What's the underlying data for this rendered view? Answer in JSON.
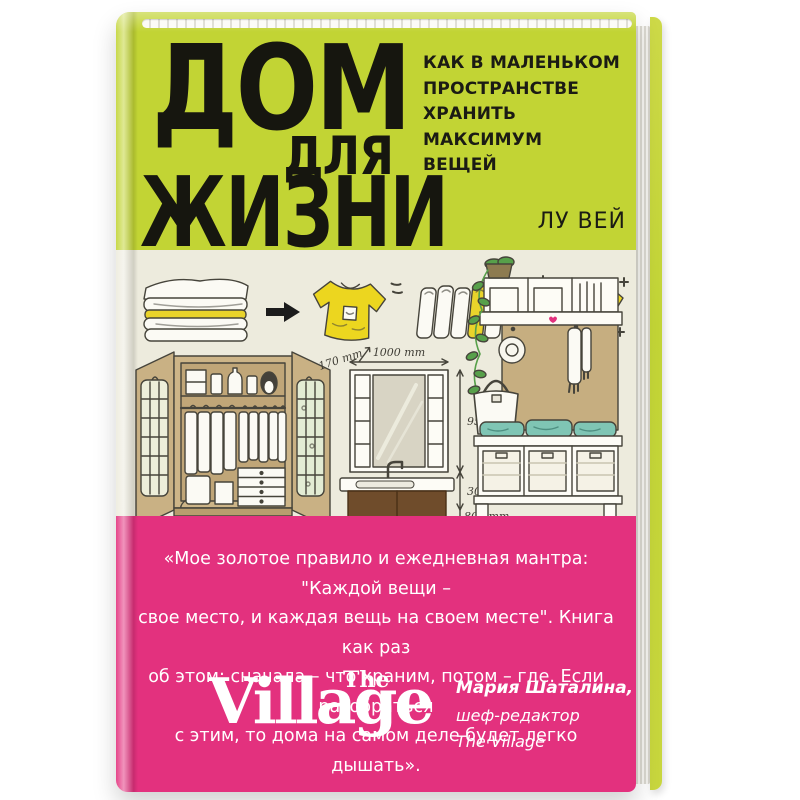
{
  "cover": {
    "title_lines": [
      "ДОМ",
      "ДЛЯ",
      "ЖИЗНИ"
    ],
    "subtitle_lines": [
      "КАК В МАЛЕНЬКОМ",
      "ПРОСТРАНСТВЕ",
      "ХРАНИТЬ",
      "МАКСИМУМ",
      "ВЕЩЕЙ"
    ],
    "author": "ЛУ ВЕЙ"
  },
  "illustration": {
    "measurements": {
      "cabinet_width": "1000 mm",
      "cabinet_depth": "170 mm",
      "cabinet_height": "950 mm",
      "gap_height": "300 mm",
      "sink_height": "800 mm"
    }
  },
  "quote": {
    "lines": [
      "«Мое золотое правило и ежедневная мантра: \"Каждой вещи –",
      "свое место, и каждая вещь на своем месте\". Книга как раз",
      "об этом: сначала – что храним, потом – где. Если разобраться",
      "с этим, то дома на самом деле будет легко дышать»."
    ]
  },
  "endorsement": {
    "logo_the": "The",
    "logo_village": "Village",
    "reviewer_name": "Мария Шаталина,",
    "reviewer_role": "шеф-редактор",
    "reviewer_org": "The Village"
  },
  "colors": {
    "cover_green": "#c2d434",
    "cover_cream": "#edebdd",
    "cover_pink": "#e3317e",
    "accent_yellow": "#e9d32b",
    "accent_teal": "#7fc5b4"
  }
}
